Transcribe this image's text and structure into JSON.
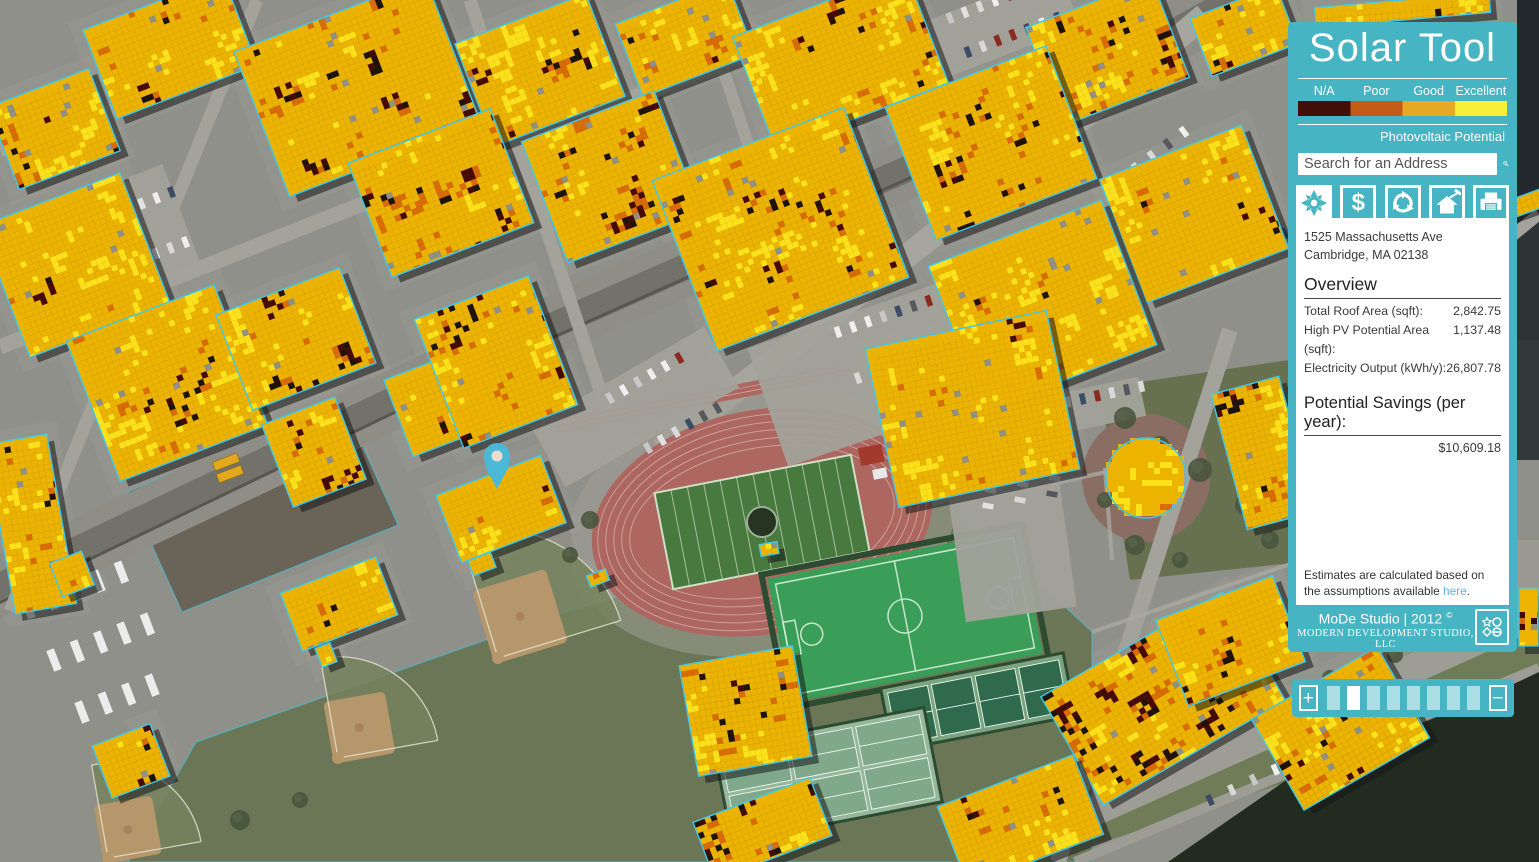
{
  "app": {
    "title": "Solar Tool"
  },
  "legend": {
    "labels": [
      "N/A",
      "Poor",
      "Good",
      "Excellent"
    ],
    "colors": [
      "#430d08",
      "#c45b17",
      "#e7a823",
      "#f5ef38"
    ],
    "caption": "Photovoltaic Potential"
  },
  "search": {
    "placeholder": "Search for an Address"
  },
  "toolbar": {
    "dollar_label": "$"
  },
  "result": {
    "address_line1": "1525 Massachusetts Ave",
    "address_line2": "Cambridge, MA 02138",
    "overview_heading": "Overview",
    "stats": [
      {
        "label": "Total Roof Area (sqft):",
        "value": "2,842.75"
      },
      {
        "label": "High PV Potential Area (sqft):",
        "value": "1,137.48"
      },
      {
        "label": "Electricity Output (kWh/y):",
        "value": "26,807.78"
      }
    ],
    "savings_heading": "Potential Savings (per year):",
    "savings_value": "$10,609.18",
    "note": {
      "before": "Estimates are calculated based on the assumptions available ",
      "link": "here",
      "after": "."
    }
  },
  "footer": {
    "studio": "MoDe Studio | 2012",
    "mark": "©",
    "company": "MODERN DEVELOPMENT STUDIO, LLC"
  },
  "zoombar": {
    "plus": "+",
    "minus": "−",
    "segments": 8,
    "active_index": 1
  },
  "theme": {
    "panel": "#46b4c3",
    "panel_text": "#ffffff",
    "link": "#57b7d9",
    "outline": "#3fc8e8",
    "pin": "#4ab9d8",
    "pin_center": "#eedcd2"
  },
  "map": {
    "w": 1539,
    "h": 862,
    "base": "#90908a",
    "palette": {
      "maroon": "#470a02",
      "black": "#1f1206",
      "orange": "#d96c04",
      "amber": "#edb301",
      "yellow": "#ffe11a",
      "speck": "#8f9086"
    },
    "areas": [
      {
        "pts": [
          [
            128,
            862
          ],
          [
            196,
            742
          ],
          [
            565,
            612
          ],
          [
            952,
            500
          ],
          [
            1092,
            632
          ],
          [
            1092,
            862
          ]
        ],
        "fill": "#6b7657",
        "outline": true
      },
      {
        "pts": [
          [
            952,
            862
          ],
          [
            1539,
            594
          ],
          [
            1539,
            700
          ],
          [
            1042,
            862
          ]
        ],
        "fill": "#707b58"
      },
      {
        "pts": [
          [
            128,
            492
          ],
          [
            342,
            400
          ],
          [
            398,
            525
          ],
          [
            182,
            612
          ]
        ],
        "fill": "#6a6358",
        "outline": true
      },
      {
        "pts": [
          [
            0,
            618
          ],
          [
            180,
            770
          ],
          [
            120,
            862
          ],
          [
            0,
            862
          ]
        ],
        "fill": "#8f9088"
      },
      {
        "pts": [
          [
            1100,
            388
          ],
          [
            1302,
            358
          ],
          [
            1302,
            562
          ],
          [
            1130,
            580
          ]
        ],
        "fill": "#67714f"
      },
      {
        "pts": [
          [
            1517,
            0
          ],
          [
            1539,
            0
          ],
          [
            1539,
            210
          ],
          [
            1517,
            210
          ]
        ],
        "fill": "#23282c"
      },
      {
        "pts": [
          [
            1517,
            210
          ],
          [
            1539,
            210
          ],
          [
            1539,
            340
          ],
          [
            1517,
            340
          ]
        ],
        "fill": "#2e3336"
      },
      {
        "pts": [
          [
            1517,
            340
          ],
          [
            1539,
            340
          ],
          [
            1539,
            460
          ],
          [
            1517,
            460
          ]
        ],
        "fill": "#33383a"
      },
      {
        "pts": [
          [
            1517,
            540
          ],
          [
            1539,
            540
          ],
          [
            1539,
            632
          ],
          [
            1517,
            632
          ]
        ],
        "fill": "#9a9a92"
      }
    ],
    "plaza": {
      "cx": 1146,
      "cy": 478,
      "r": 64,
      "fill": "#8b6e63"
    },
    "roads": [
      {
        "pts": [
          [
            -30,
            600
          ],
          [
            520,
            340
          ],
          [
            1000,
            128
          ],
          [
            1250,
            -10
          ]
        ],
        "w": 58,
        "c": "#8e8e87"
      },
      {
        "pts": [
          [
            -30,
            600
          ],
          [
            520,
            340
          ],
          [
            1000,
            128
          ],
          [
            1250,
            -10
          ]
        ],
        "w": 26,
        "c": "#72726b"
      },
      {
        "pts": [
          [
            -20,
            612
          ],
          [
            520,
            352
          ],
          [
            995,
            140
          ]
        ],
        "w": 3,
        "c": "#57574f"
      },
      {
        "pts": [
          [
            660,
            450
          ],
          [
            1080,
            120
          ],
          [
            1205,
            15
          ]
        ],
        "w": 24,
        "c": "#a6a69e"
      },
      {
        "pts": [
          [
            0,
            150
          ],
          [
            430,
            0
          ]
        ],
        "w": 14,
        "c": "#a3a39b"
      },
      {
        "pts": [
          [
            0,
            347
          ],
          [
            880,
            0
          ]
        ],
        "w": 15,
        "c": "#a3a39b"
      },
      {
        "pts": [
          [
            257,
            0
          ],
          [
            10,
            611
          ]
        ],
        "w": 13,
        "c": "#a3a39b"
      },
      {
        "pts": [
          [
            470,
            0
          ],
          [
            610,
            420
          ]
        ],
        "w": 13,
        "c": "#a3a39b"
      },
      {
        "pts": [
          [
            700,
            0
          ],
          [
            800,
            300
          ]
        ],
        "w": 12,
        "c": "#a3a39b"
      },
      {
        "pts": [
          [
            1230,
            330
          ],
          [
            1058,
            862
          ]
        ],
        "w": 16,
        "c": "#a3a39b"
      },
      {
        "pts": [
          [
            1480,
            262
          ],
          [
            1539,
            214
          ]
        ],
        "w": 12,
        "c": "#a3a39b"
      },
      {
        "pts": [
          [
            980,
            862
          ],
          [
            1539,
            612
          ]
        ],
        "w": 30,
        "c": "#9d9d95"
      },
      {
        "pts": [
          [
            1075,
            862
          ],
          [
            1539,
            668
          ]
        ],
        "w": 10,
        "c": "#9d9d95"
      }
    ],
    "water": {
      "pts": [
        [
          1168,
          862
        ],
        [
          1298,
          772
        ],
        [
          1480,
          700
        ],
        [
          1539,
          672
        ],
        [
          1539,
          862
        ]
      ],
      "fill": "#222b20"
    },
    "paths": [
      [
        [
          950,
          505
        ],
        [
          1125,
          468
        ]
      ],
      [
        [
          1105,
          468
        ],
        [
          1112,
          560
        ]
      ],
      [
        [
          1092,
          632
        ],
        [
          1302,
          560
        ]
      ]
    ],
    "track": {
      "cx": 762,
      "cy": 522,
      "rot": -11
    },
    "turf": {
      "cx": 905,
      "cy": 616,
      "w": 256,
      "h": 126,
      "rot": -11
    },
    "tennis": [
      {
        "cx": 978,
        "cy": 702,
        "w": 186,
        "h": 64,
        "rot": -11,
        "cols": 4,
        "rows": 1,
        "surface": "#7ba581",
        "court": "#2e6a4b"
      },
      {
        "cx": 828,
        "cy": 775,
        "w": 214,
        "h": 96,
        "rot": -11,
        "cols": 3,
        "rows": 2,
        "surface": "#97b79c",
        "court": "#7fa98a"
      },
      {
        "cx": 738,
        "cy": 708,
        "w": 74,
        "h": 52,
        "rot": -11,
        "cols": 2,
        "rows": 1,
        "surface": "#6f9d79",
        "court": "#2e6a4b"
      }
    ],
    "baseball": [
      {
        "hx": 498,
        "hy": 658,
        "dir": -62,
        "size": 95
      },
      {
        "hx": 338,
        "hy": 758,
        "dir": -55,
        "size": 75
      },
      {
        "hx": 108,
        "hy": 858,
        "dir": -55,
        "size": 70
      }
    ],
    "parking": [
      [
        12,
        192,
        175,
        105,
        -21
      ],
      [
        760,
        298,
        290,
        125,
        -19
      ],
      [
        535,
        372,
        200,
        70,
        -30
      ],
      [
        956,
        480,
        112,
        135,
        -8
      ],
      [
        925,
        -5,
        150,
        60,
        -21
      ],
      [
        1058,
        385,
        85,
        40,
        -12
      ]
    ],
    "car_rows": [
      [
        52,
        238,
        -21,
        9,
        16,
        0
      ],
      [
        66,
        288,
        -21,
        9,
        16,
        0
      ],
      [
        838,
        332,
        -19,
        10,
        16,
        0
      ],
      [
        858,
        378,
        -19,
        9,
        16,
        0
      ],
      [
        884,
        422,
        -19,
        7,
        16,
        0
      ],
      [
        610,
        398,
        -30,
        6,
        16,
        0
      ],
      [
        648,
        448,
        -30,
        6,
        16,
        0
      ],
      [
        988,
        506,
        -80,
        5,
        16,
        0
      ],
      [
        1020,
        500,
        -80,
        5,
        16,
        0
      ],
      [
        1052,
        494,
        -80,
        5,
        16,
        0
      ],
      [
        950,
        18,
        -21,
        8,
        16,
        0
      ],
      [
        968,
        52,
        -21,
        7,
        16,
        0
      ],
      [
        1068,
        402,
        -12,
        6,
        15,
        0
      ],
      [
        28,
        608,
        -21,
        5,
        25,
        1
      ],
      [
        54,
        660,
        -21,
        5,
        25,
        1
      ],
      [
        82,
        712,
        -21,
        4,
        25,
        1
      ],
      [
        1120,
        180,
        -37,
        5,
        20,
        0
      ],
      [
        1235,
        262,
        -30,
        5,
        19,
        0
      ],
      [
        1210,
        800,
        -25,
        4,
        24,
        0
      ]
    ],
    "trees": [
      [
        1125,
        418,
        11
      ],
      [
        1160,
        445,
        9
      ],
      [
        1200,
        470,
        12
      ],
      [
        1245,
        505,
        10
      ],
      [
        1270,
        540,
        9
      ],
      [
        1135,
        545,
        10
      ],
      [
        1180,
        560,
        8
      ],
      [
        1290,
        470,
        8
      ],
      [
        20,
        120,
        12
      ],
      [
        48,
        148,
        9
      ],
      [
        640,
        52,
        7
      ],
      [
        590,
        520,
        9
      ],
      [
        570,
        555,
        8
      ],
      [
        1105,
        500,
        8
      ],
      [
        240,
        820,
        10
      ],
      [
        300,
        800,
        8
      ],
      [
        1050,
        790,
        9
      ],
      [
        1100,
        768,
        8
      ],
      [
        1150,
        745,
        9
      ],
      [
        1210,
        722,
        8
      ],
      [
        1270,
        700,
        8
      ],
      [
        1330,
        678,
        8
      ],
      [
        1395,
        655,
        8
      ],
      [
        1460,
        632,
        8
      ]
    ],
    "buildings": [
      [
        95,
        0,
        150,
        95,
        -21,
        0.25
      ],
      [
        255,
        10,
        205,
        155,
        -21,
        0.45
      ],
      [
        470,
        15,
        140,
        110,
        -21,
        0.5
      ],
      [
        625,
        0,
        120,
        78,
        -21,
        0.3
      ],
      [
        748,
        0,
        185,
        120,
        -21,
        0.2
      ],
      [
        1040,
        0,
        135,
        105,
        -21,
        0.45
      ],
      [
        1198,
        0,
        92,
        62,
        -21,
        0.35
      ],
      [
        1315,
        0,
        175,
        20,
        -5,
        0.3
      ],
      [
        0,
        85,
        108,
        88,
        -21,
        0.3
      ],
      [
        0,
        195,
        150,
        140,
        -21,
        0.35
      ],
      [
        88,
        308,
        158,
        150,
        -21,
        0.3
      ],
      [
        365,
        132,
        152,
        122,
        -21,
        0.35
      ],
      [
        540,
        112,
        142,
        130,
        -21,
        0.3
      ],
      [
        678,
        138,
        205,
        182,
        -21,
        0.25
      ],
      [
        905,
        72,
        172,
        142,
        -21,
        0.3
      ],
      [
        1118,
        148,
        152,
        132,
        -21,
        0.25
      ],
      [
        950,
        228,
        185,
        155,
        -21,
        0.2
      ],
      [
        230,
        288,
        132,
        102,
        -21,
        0.55
      ],
      [
        395,
        358,
        108,
        82,
        -21,
        0.2
      ],
      [
        435,
        293,
        122,
        138,
        -21,
        0.35
      ],
      [
        275,
        408,
        78,
        88,
        -21,
        0.3
      ],
      [
        0,
        438,
        62,
        172,
        -10,
        0.3
      ],
      [
        288,
        573,
        102,
        62,
        -21,
        0.35
      ],
      [
        55,
        556,
        34,
        36,
        -21,
        0.15
      ],
      [
        100,
        733,
        62,
        56,
        -21,
        0.4
      ],
      [
        445,
        473,
        112,
        72,
        -21,
        0.2
      ],
      [
        880,
        328,
        185,
        162,
        -12,
        0.15
      ],
      [
        1228,
        383,
        70,
        140,
        -15,
        0.3
      ],
      [
        688,
        655,
        115,
        112,
        -10,
        0.3
      ],
      [
        1058,
        636,
        210,
        125,
        -30,
        0.6
      ],
      [
        1168,
        595,
        125,
        92,
        -21,
        0.35
      ],
      [
        948,
        778,
        145,
        85,
        -21,
        0.3
      ],
      [
        700,
        798,
        125,
        62,
        -21,
        0.35
      ],
      [
        1268,
        676,
        145,
        105,
        -30,
        0.45
      ],
      [
        1519,
        180,
        18,
        46,
        70,
        0.75
      ],
      [
        1519,
        588,
        19,
        58,
        0,
        0.3
      ],
      [
        470,
        556,
        24,
        16,
        -21,
        0.1
      ],
      [
        588,
        572,
        20,
        12,
        -21,
        0.1
      ],
      [
        318,
        645,
        16,
        20,
        -21,
        0.1
      ],
      [
        760,
        543,
        18,
        12,
        -10,
        0.1
      ]
    ],
    "dome": {
      "cx": 1146,
      "cy": 478,
      "r": 40,
      "bias": 0.35
    },
    "buses": [
      [
        226,
        462,
        -21
      ],
      [
        230,
        474,
        -21
      ]
    ],
    "pin": {
      "x": 497,
      "y": 458
    }
  }
}
